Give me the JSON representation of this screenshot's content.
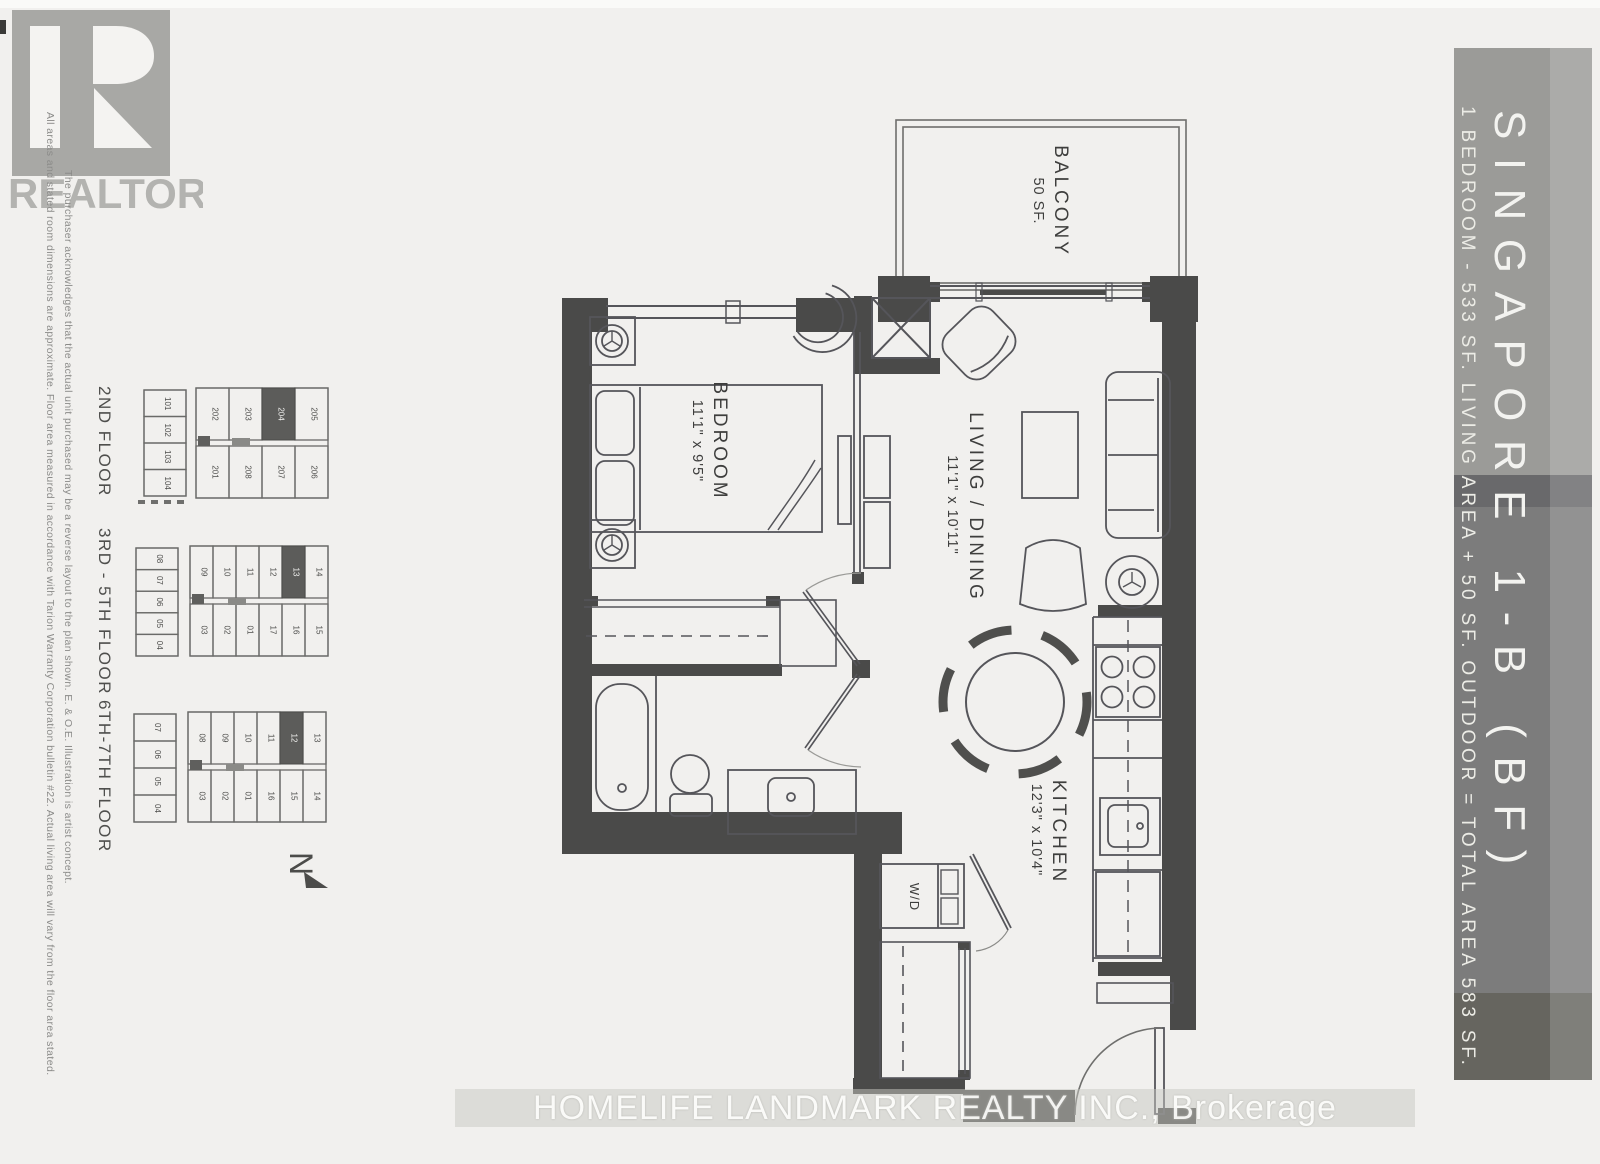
{
  "realtor": {
    "wordmark": "REALTOR",
    "registered": "®"
  },
  "disclaimer": {
    "line1": "All areas and stated room dimensions are approximate.  Floor area measured in accordance with Tarion Warranty Corporation bulletin #22.  Actual living area will vary from the floor area stated.",
    "line2": "The purchaser acknowledges that the actual unit purchased may be a reverse layout to the plan shown. E. & O.E.  Illustration is artist concept."
  },
  "banner": {
    "title": "SINGAPORE 1-B (BF)",
    "subtitle": "1 BEDROOM - 533 SF. LIVING AREA + 50 SF. OUTDOOR = TOTAL AREA 583 SF.",
    "colors": {
      "top": "#9b9b98",
      "dark_band": "#69696b",
      "mid": "#7c7c7c",
      "bottom": "#66655f"
    }
  },
  "keyplans": [
    {
      "label": "2ND FLOOR",
      "left": [
        "101",
        "102",
        "103",
        "104"
      ],
      "top": [
        "202",
        "203",
        "204",
        "205"
      ],
      "bottom": [
        "201",
        "208",
        "207",
        "206"
      ],
      "highlight": "204"
    },
    {
      "label": "3RD - 5TH FLOOR",
      "left": [
        "08",
        "07",
        "06",
        "05",
        "04"
      ],
      "top": [
        "09",
        "10",
        "11",
        "12",
        "13",
        "14"
      ],
      "bottom": [
        "03",
        "02",
        "01",
        "17",
        "16",
        "15"
      ],
      "highlight": "13"
    },
    {
      "label": "6TH-7TH FLOOR",
      "left": [
        "07",
        "06",
        "05",
        "04"
      ],
      "top": [
        "08",
        "09",
        "10",
        "11",
        "12",
        "13"
      ],
      "bottom": [
        "03",
        "02",
        "01",
        "16",
        "15",
        "14"
      ],
      "highlight": "12"
    }
  ],
  "north": {
    "letter": "N"
  },
  "plan": {
    "balcony_name": "BALCONY",
    "balcony_area": "50 SF.",
    "bedroom_name": "BEDROOM",
    "bedroom_dims": "11'1\" x 9'5\"",
    "living_name": "LIVING / DINING",
    "living_dims": "11'1\" x 10'11\"",
    "kitchen_name": "KITCHEN",
    "kitchen_dims": "12'3\" x 10'4\"",
    "laundry_label": "W/D",
    "wall_color": "#4a4a49"
  },
  "watermark": "HOMELIFE LANDMARK REALTY INC., Brokerage"
}
